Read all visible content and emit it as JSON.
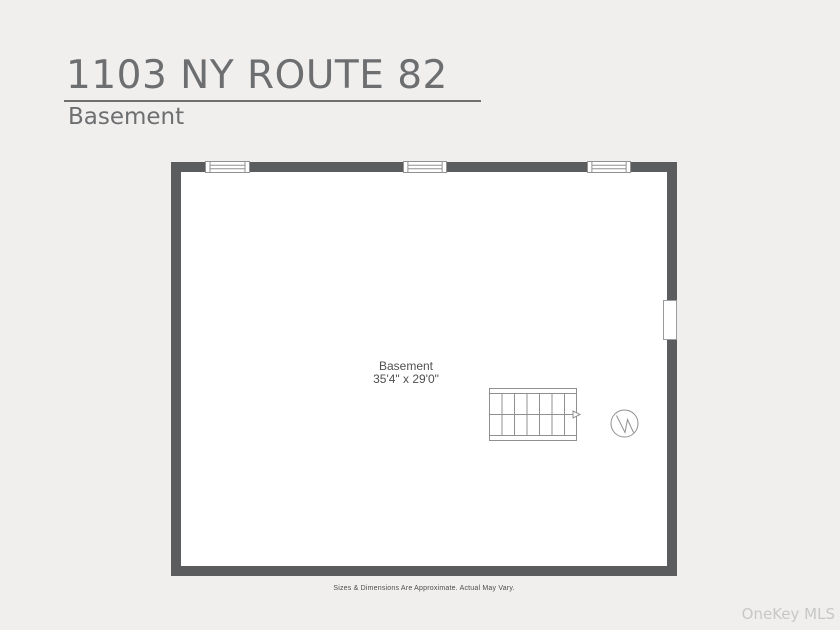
{
  "header": {
    "title": "1103 NY ROUTE 82",
    "subtitle": "Basement"
  },
  "floorplan": {
    "room": {
      "name": "Basement",
      "dimensions": "35'4\" x 29'0\""
    },
    "top_wall_window_count": 3,
    "right_wall_opening": "door-opening",
    "symbols": [
      "staircase-with-direction-arrow",
      "circle-zigzag-fixture"
    ],
    "colors": {
      "wall": "#5a5c5e",
      "interior": "#ffffff",
      "plan_lines": "#8f9091",
      "background": "#f0efee",
      "heading_text": "#6d6e70",
      "label_text": "#505051",
      "watermark_text": "#c7c7c7"
    }
  },
  "footer": {
    "disclaimer": "Sizes & Dimensions Are Approximate. Actual May Vary.",
    "watermark": "OneKey MLS"
  }
}
